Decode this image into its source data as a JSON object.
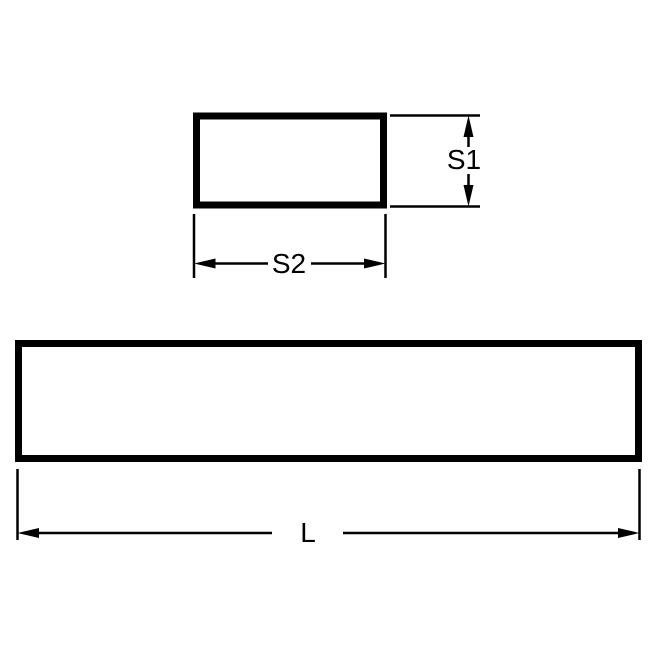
{
  "diagram": {
    "labels": {
      "s1": "S1",
      "s2": "S2",
      "l": "L"
    },
    "colors": {
      "line": "#000000",
      "background": "#ffffff"
    }
  }
}
